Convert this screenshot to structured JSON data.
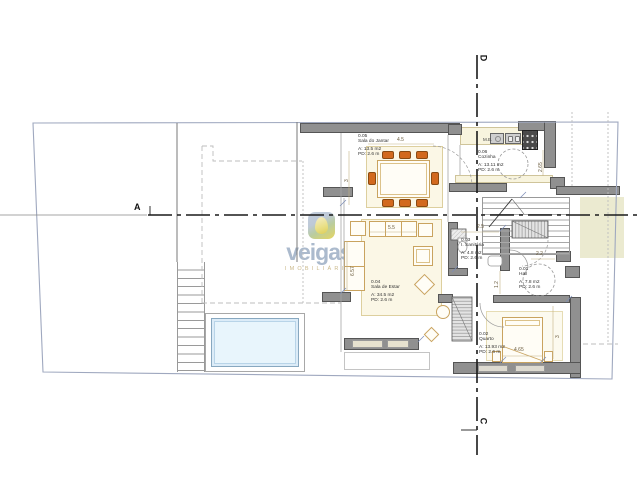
{
  "watermark": {
    "brand": "veigas",
    "subtitle": "IMOBILIÁRIA"
  },
  "section_markers": {
    "left": "A",
    "top": "D",
    "bottom": "C"
  },
  "rooms": [
    {
      "number": "0.05",
      "name": "Sala do Jantar",
      "area": "A: 13.5 m2",
      "ceiling": "PD: 2.6 m"
    },
    {
      "number": "0.06",
      "name": "Cozinha",
      "area": "A: 13.11 m2",
      "ceiling": "PD: 2.6 m"
    },
    {
      "number": "0.03",
      "name": "I. Sanitária",
      "area": "A: 4.8 m2",
      "ceiling": "PD: 2.6 m"
    },
    {
      "number": "0.01",
      "name": "Hall",
      "area": "A: 7.8 m2",
      "ceiling": "PD: 2.6 m"
    },
    {
      "number": "0.04",
      "name": "Sala de Estar",
      "area": "A: 34.5 m2",
      "ceiling": "PD: 2.6 m"
    },
    {
      "number": "0.02",
      "name": "Quarto",
      "area": "A: 13.93 m2",
      "ceiling": "PD: 2.6 m"
    }
  ],
  "annotations": {
    "kitchen_unit": "M.E."
  },
  "dimensions": {
    "dining_width": "4.5",
    "dining_depth": "3",
    "kitchen_depth": "2.65",
    "living_width": "5.5",
    "living_depth": "6.57",
    "bath_width": "2.5",
    "hall_depth": "1.2",
    "hall_width": "2.2",
    "bed_width": "4.65",
    "bedroom_depth": "3"
  },
  "colors": {
    "wall": "#909090",
    "wall_edge": "#555555",
    "furniture_outline": "#c9a35f",
    "chair": "#d2691e",
    "rug": "#fbf7e6",
    "pool_water": "#e8f5fc",
    "terrace": "#ebead0",
    "boundary": "#9fa8bf",
    "section_line": "#1a1a1a",
    "watermark_text": "#8ba0ba",
    "watermark_subtitle": "#c5b278"
  }
}
